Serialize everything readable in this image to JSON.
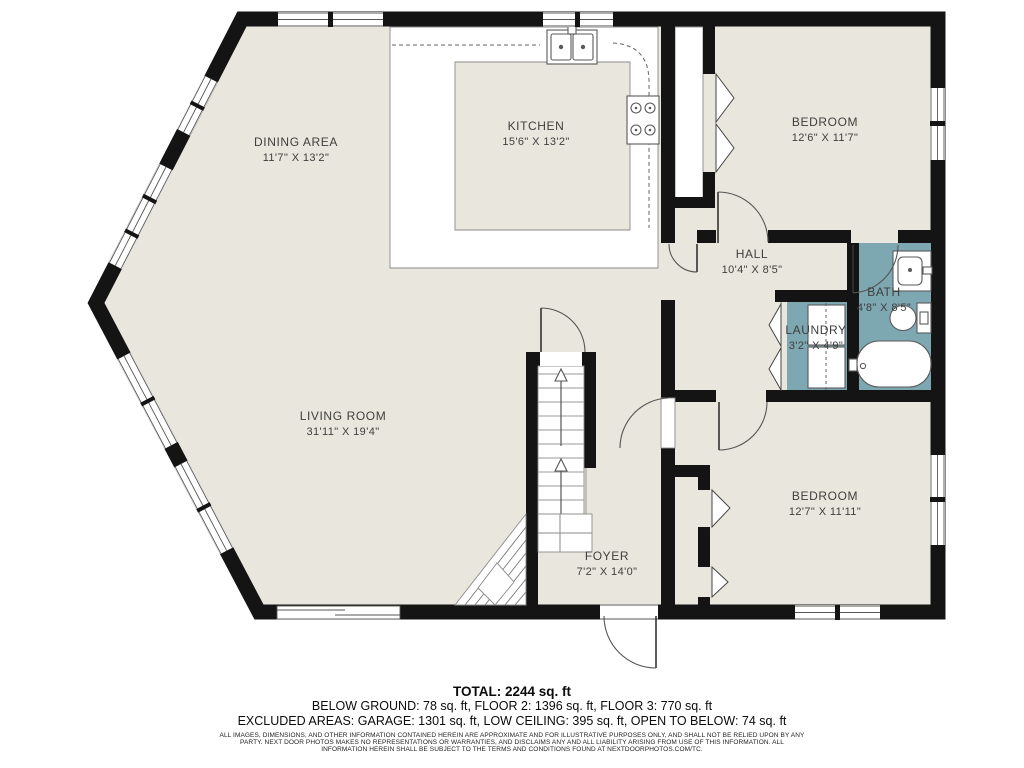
{
  "plan": {
    "colors": {
      "floor": "#e9e7dd",
      "wall": "#141414",
      "wet_floor": "#7da7b1",
      "label_text": "#3e3e3e"
    },
    "rooms": [
      {
        "id": "dining-area",
        "name": "DINING AREA",
        "dims": "11'7\" X 13'2\""
      },
      {
        "id": "kitchen",
        "name": "KITCHEN",
        "dims": "15'6\" X 13'2\""
      },
      {
        "id": "bedroom-1",
        "name": "BEDROOM",
        "dims": "12'6\" X 11'7\""
      },
      {
        "id": "hall",
        "name": "HALL",
        "dims": "10'4\" X 8'5\""
      },
      {
        "id": "bath",
        "name": "BATH",
        "dims": "4'8\" X 8'5\""
      },
      {
        "id": "laundry",
        "name": "LAUNDRY",
        "dims": "3'2\" X 4'9\""
      },
      {
        "id": "living-room",
        "name": "LIVING ROOM",
        "dims": "31'11\" X 19'4\""
      },
      {
        "id": "bedroom-2",
        "name": "BEDROOM",
        "dims": "12'7\" X 11'11\""
      },
      {
        "id": "foyer",
        "name": "FOYER",
        "dims": "7'2\" X 14'0\""
      }
    ],
    "fixtures": [
      {
        "icon": "kitchen-sink-icon"
      },
      {
        "icon": "stove-icon"
      },
      {
        "icon": "bathroom-vanity-icon"
      },
      {
        "icon": "toilet-icon"
      },
      {
        "icon": "bathtub-icon"
      },
      {
        "icon": "washer-dryer-icon"
      },
      {
        "icon": "stairs-up-icon"
      },
      {
        "icon": "basement-stairs-icon"
      },
      {
        "icon": "stair-landing-icon"
      }
    ]
  },
  "footer": {
    "total": "TOTAL: 2244 sq. ft",
    "floors": "BELOW GROUND: 78 sq. ft, FLOOR 2: 1396 sq. ft, FLOOR 3: 770 sq. ft",
    "excluded": "EXCLUDED AREAS: GARAGE: 1301 sq. ft, LOW CEILING: 395 sq. ft, OPEN TO BELOW: 74 sq. ft",
    "disclaimer": "ALL IMAGES, DIMENSIONS, AND OTHER INFORMATION CONTAINED HEREIN ARE APPROXIMATE AND FOR ILLUSTRATIVE PURPOSES ONLY, AND SHALL NOT BE RELIED UPON BY ANY PARTY. NEXT DOOR PHOTOS MAKES NO REPRESENTATIONS OR WARRANTIES, AND DISCLAIMS ANY AND ALL LIABILITY ARISING FROM USE OF THIS INFORMATION. ALL INFORMATION HEREIN SHALL BE SUBJECT TO THE TERMS AND CONDITIONS FOUND AT NEXTDOORPHOTOS.COM/TC."
  }
}
